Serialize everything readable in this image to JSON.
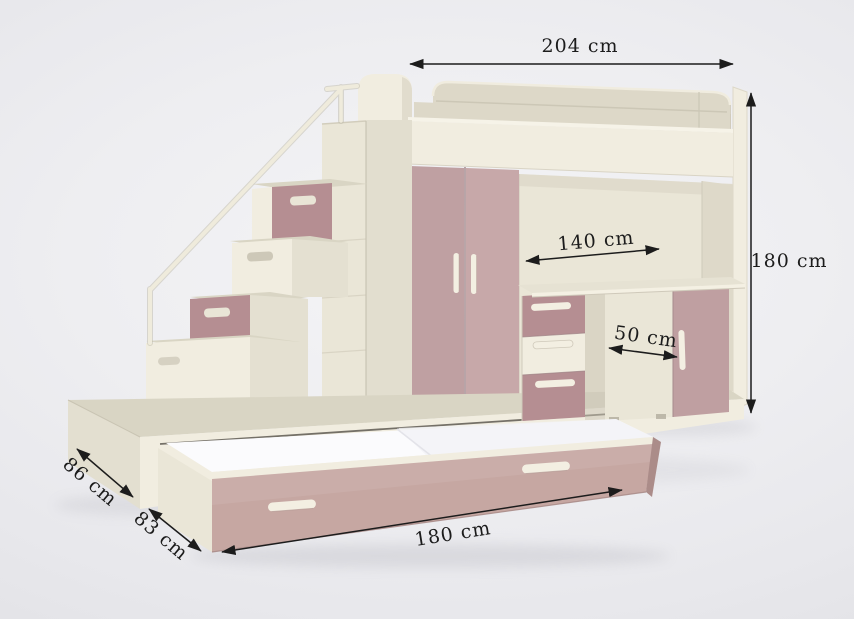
{
  "product_view": {
    "type": "furniture-dimension-render",
    "subject": "loft-bed-with-stairs-wardrobe-desk-trundle"
  },
  "dimensions": {
    "overall_width": {
      "label": "204 cm"
    },
    "overall_height": {
      "label": "180 cm"
    },
    "desk_width": {
      "label": "140 cm"
    },
    "desk_depth": {
      "label": "50 cm"
    },
    "platform_depth": {
      "label": "86 cm"
    },
    "trundle_depth": {
      "label": "83 cm"
    },
    "trundle_width": {
      "label": "180 cm"
    }
  },
  "colors": {
    "background": "#ededf0",
    "cream-bright": "#f1ede0",
    "cream": "#eae6d7",
    "cream-shade": "#ddd8c8",
    "cream-dark": "#d6d2c0",
    "cream-top": "#d9d5c4",
    "mauve": "#c3a4a5",
    "mauve-dark": "#b58e92",
    "mauve-soft": "#c6a7a2",
    "mauve-deep": "#bf9fa1",
    "handle": "#f3efe2",
    "mattress": "#fbfbfd",
    "dimension-line": "#1c1c1c"
  }
}
